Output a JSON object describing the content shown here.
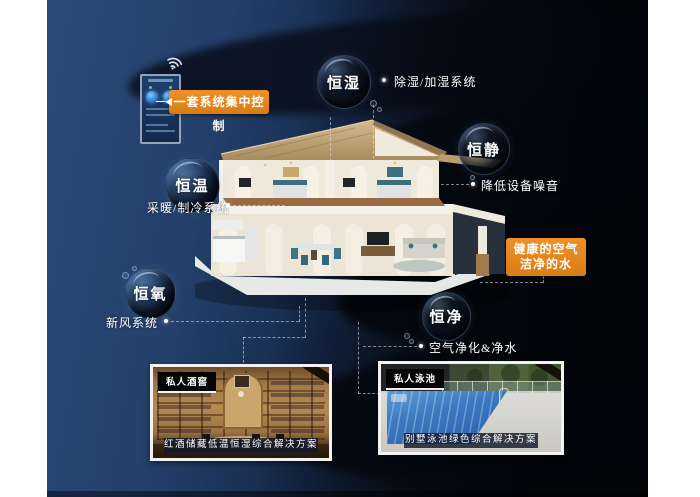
{
  "poster": {
    "theme": "smart-home-whole-house-system",
    "control": {
      "label": "一套系统集中控制"
    },
    "bubbles": [
      {
        "label": "恒湿",
        "note": "除湿/加湿系统"
      },
      {
        "label": "恒静",
        "note": "降低设备噪音"
      },
      {
        "label": "恒温",
        "note": "采暖/制冷系统"
      },
      {
        "label": "恒氧",
        "note": "新风系统"
      },
      {
        "label": "恒净",
        "note": "空气净化&净水"
      }
    ],
    "highlight": {
      "line1": "健康的空气",
      "line2": "洁净的水"
    },
    "photos": [
      {
        "tag": "私人酒窖",
        "caption": "红酒储藏低温恒湿综合解决方案"
      },
      {
        "tag": "私人泳池",
        "caption": "别墅泳池绿色综合解决方案"
      }
    ],
    "icons": {
      "wifi": "wifi-icon",
      "control_device": "smart-panel-icon"
    },
    "colors": {
      "accent_orange": "#e2831d",
      "navy": "#24416b",
      "near_black": "#05080d",
      "text": "#ffffff",
      "roof_tan": "#c3a87c",
      "pool_blue": "#3b79c0"
    }
  }
}
